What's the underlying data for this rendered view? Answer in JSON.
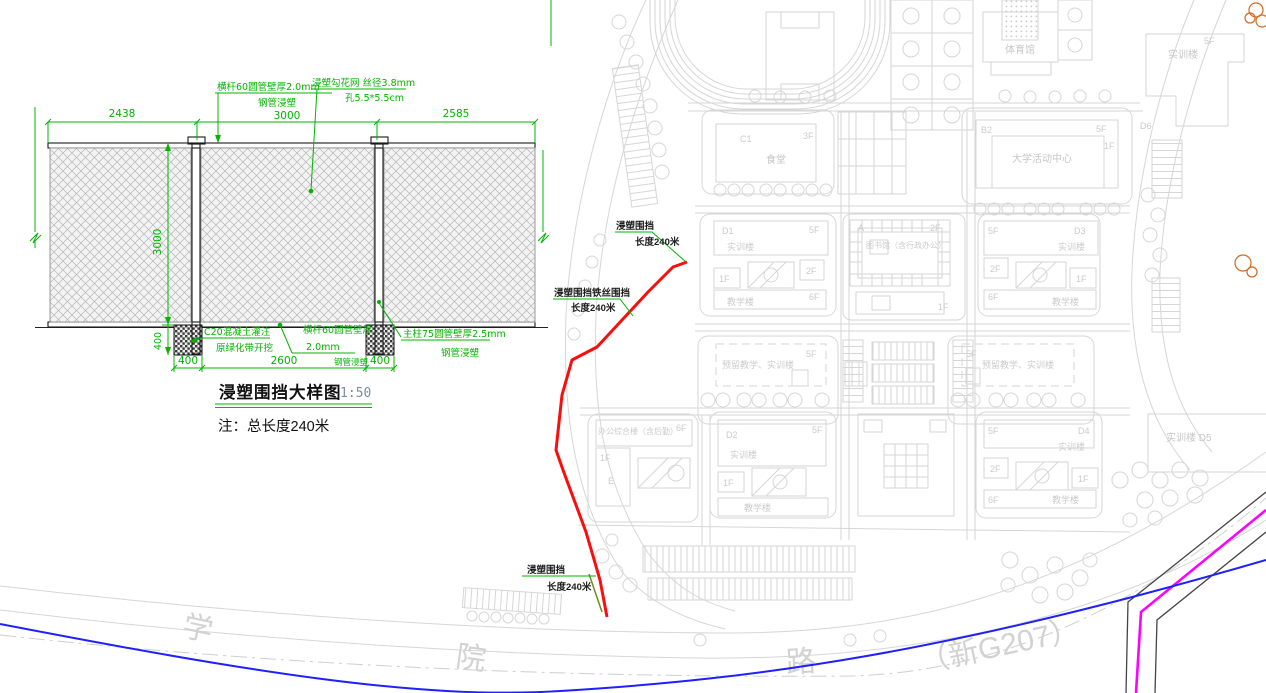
{
  "detail": {
    "title": "浸塑围挡大样图",
    "scale": "1:50",
    "note": "注：总长度240米",
    "dim_top_left": "2438",
    "dim_top_mid": "3000",
    "dim_top_right": "2585",
    "dim_height": "3000",
    "dim_footing_depth": "400",
    "dim_bottom_left": "400",
    "dim_bottom_mid": "2600",
    "dim_bottom_right": "400",
    "label_toprail_1": "横杆60圆管壁厚2.0mm",
    "label_toprail_2": "钢管浸塑",
    "label_mesh_1": "浸塑勾花网 丝径3.8mm",
    "label_mesh_2": "孔5.5*5.5cm",
    "label_footing_1": "C20混凝土灌注",
    "label_footing_2": "原绿化带开挖",
    "label_botrail_1": "横杆60圆管壁厚",
    "label_botrail_2": "2.0mm",
    "label_botrail_3": "钢管浸塑",
    "label_post_1": "主柱75圆管壁厚2.5mm",
    "label_post_2": "钢管浸塑"
  },
  "fence": {
    "label1_line1": "浸塑围挡",
    "label1_line2": "长度240米",
    "label2_line1": "浸塑围挡铁丝围挡",
    "label2_line2": "长度240米",
    "label3_line1": "浸塑围挡",
    "label3_line2": "长度240米"
  },
  "map": {
    "gym": "体育馆",
    "c1_code": "C1",
    "c1_name": "食堂",
    "c1_floor": "3F",
    "b2_code": "B2",
    "b2_name": "大学活动中心",
    "d1_code": "D1",
    "d2_code": "D2",
    "d3_code": "D3",
    "d4_code": "D4",
    "training_name": "实训楼",
    "teaching_name": "教学楼",
    "library_code": "A",
    "library_name": "图书馆（含行政办公）",
    "reserved_name": "预留教学、实训楼",
    "office_name": "办公综合楼（含后勤）",
    "office_code": "E",
    "d5_name": "实训楼 D5",
    "d6_code": "D6",
    "f1": "1F",
    "f2": "2F",
    "f3": "3F",
    "f5": "5F",
    "f6": "6F"
  },
  "road": {
    "char1": "学",
    "char2": "院",
    "char3": "路",
    "suffix": "（新G207）"
  },
  "colors": {
    "dim_green": "#00b400",
    "fence_red": "#fb0d0d",
    "road_blue": "#1f1fff",
    "pipeline_magenta": "#ff00ff",
    "map_gray": "#d6d6d6",
    "tree_orange": "#d2691e"
  }
}
